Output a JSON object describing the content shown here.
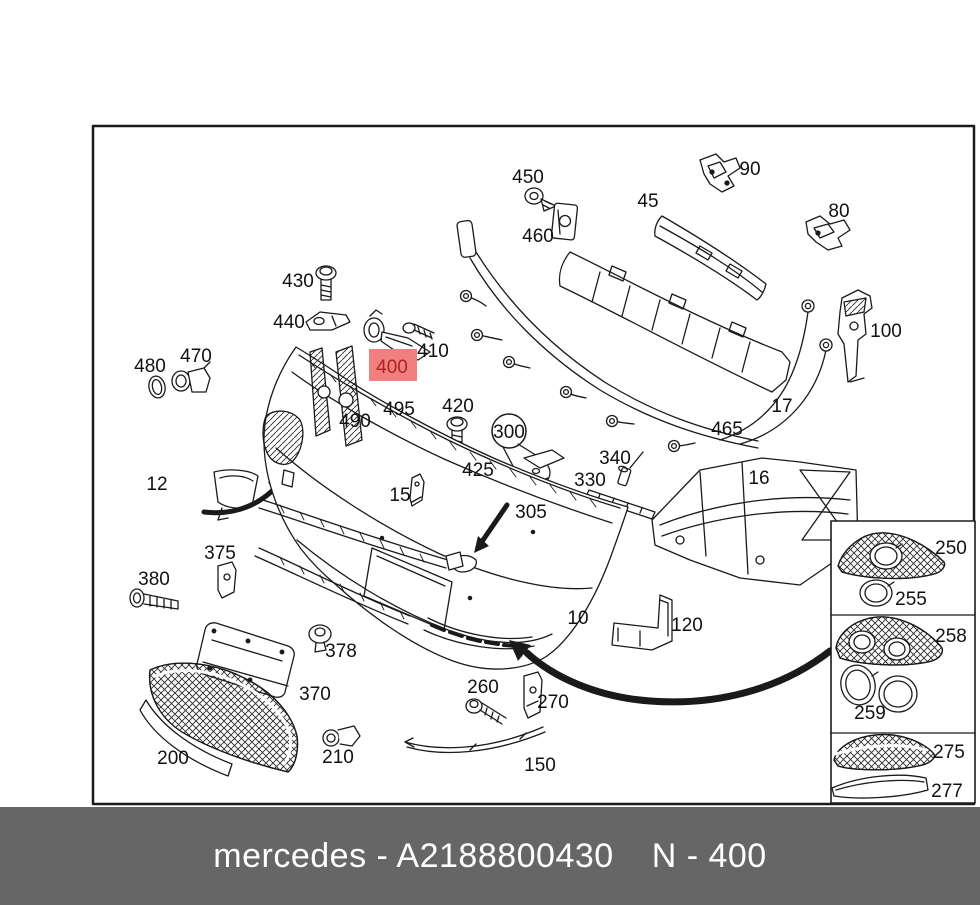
{
  "footer": {
    "part_code": "mercedes - A2188800430",
    "note": "N - 400"
  },
  "highlighted_part": {
    "number": "400",
    "bg_color": "#f08080",
    "text_color": "#b22222"
  },
  "colors": {
    "line": "#1a1a1a",
    "footer_bg": "#666666",
    "footer_text": "#ffffff",
    "paper": "#ffffff"
  },
  "part_labels": {
    "10": "10",
    "12": "12",
    "15": "15",
    "16": "16",
    "17": "17",
    "45": "45",
    "80": "80",
    "90": "90",
    "100": "100",
    "120": "120",
    "150": "150",
    "200": "200",
    "210": "210",
    "250": "250",
    "255": "255",
    "258": "258",
    "259": "259",
    "260": "260",
    "270": "270",
    "275": "275",
    "277": "277",
    "300": "300",
    "305": "305",
    "330": "330",
    "340": "340",
    "370": "370",
    "375": "375",
    "378": "378",
    "380": "380",
    "410": "410",
    "420": "420",
    "425": "425",
    "430": "430",
    "440": "440",
    "450": "450",
    "460": "460",
    "465": "465",
    "470": "470",
    "480": "480",
    "490": "490",
    "495": "495"
  }
}
